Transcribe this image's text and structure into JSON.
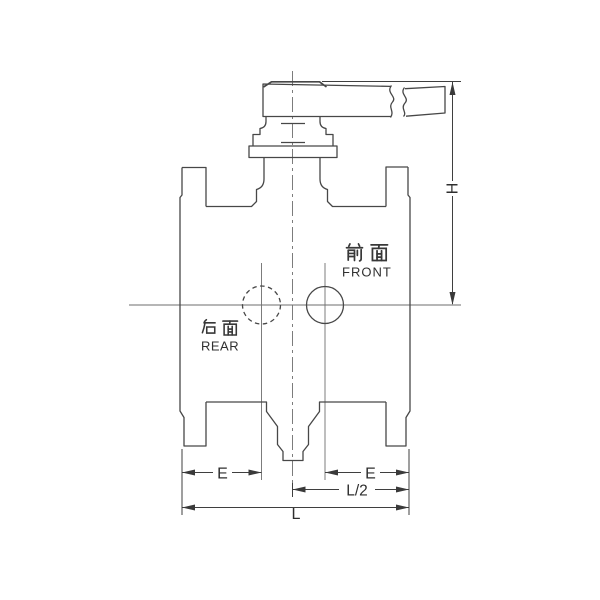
{
  "drawing": {
    "description": "valve-front-view-technical-drawing",
    "labels": {
      "front_cn": "前面",
      "front_en": "FRONT",
      "rear_cn": "后面",
      "rear_en": "REAR"
    },
    "dimensions": {
      "height": "H",
      "end_left": "E",
      "end_right": "E",
      "half_length": "L/2",
      "overall_length": "L"
    },
    "colors": {
      "background": "#ffffff",
      "outline": "#474747",
      "centerline": "#6e6e6e",
      "dimension": "#3a3a3a"
    }
  }
}
